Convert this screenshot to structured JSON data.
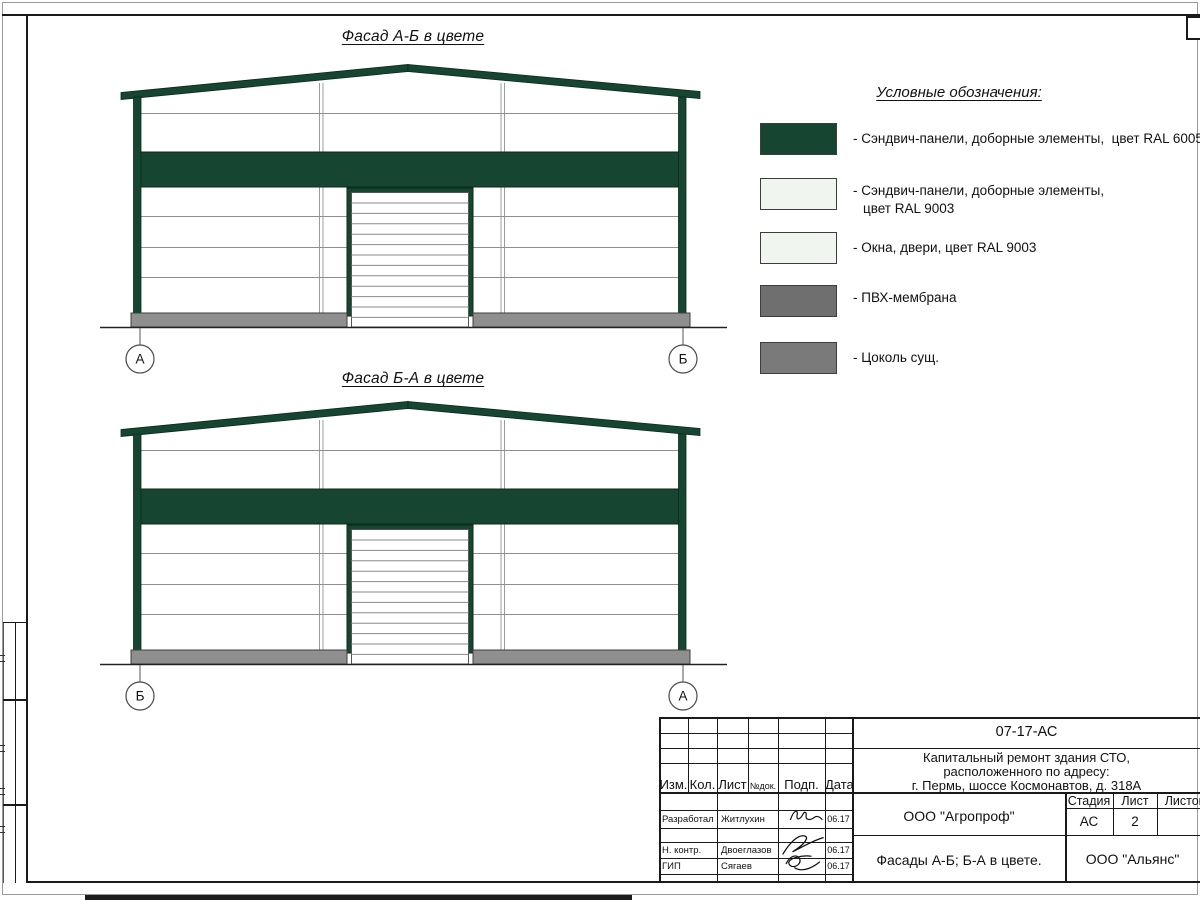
{
  "facades": {
    "top": {
      "title": "Фасад А-Б в цвете",
      "marker_left": "А",
      "marker_right": "Б"
    },
    "bottom": {
      "title": "Фасад Б-А в цвете",
      "marker_left": "Б",
      "marker_right": "А"
    }
  },
  "legend": {
    "title": "Условные обозначения:",
    "items": [
      {
        "color": "#164631",
        "label": "- Сэндвич-панели, доборные элементы,  цвет RAL 6005"
      },
      {
        "color": "#f0f5f0",
        "label": "- Сэндвич-панели, доборные элементы,",
        "label2": "цвет RAL 9003"
      },
      {
        "color": "#f0f5f0",
        "label": "- Окна, двери, цвет RAL 9003"
      },
      {
        "color": "#6f6f6f",
        "label": "- ПВХ-мембрана"
      },
      {
        "color": "#7a7a7a",
        "label": "- Цоколь сущ."
      }
    ]
  },
  "title_block": {
    "doc_number": "07-17-АС",
    "project_line1": "Капитальный ремонт здания СТО,",
    "project_line2": "расположенного по адресу:",
    "project_line3": "г. Пермь, шоссе Космонавтов, д. 318А",
    "col_izm": "Изм.",
    "col_kol": "Кол.",
    "col_list": "Лист",
    "col_ndok": "№док.",
    "col_podp": "Подп.",
    "col_data": "Дата",
    "rows": [
      {
        "role": "Разработал",
        "name": "Житлухин",
        "date": "06.17"
      },
      {
        "role": "Н. контр.",
        "name": "Двоеглазов",
        "date": "06.17"
      },
      {
        "role": "ГИП",
        "name": "Сягаев",
        "date": "06.17"
      }
    ],
    "org": "ООО \"Агропроф\"",
    "stage_label": "Стадия",
    "sheet_label": "Лист",
    "sheets_label": "Листов",
    "stage": "АС",
    "sheet_num": "2",
    "drawing_title": "Фасады А-Б; Б-А в цвете.",
    "contractor": "ООО \"Альянс\""
  },
  "colors": {
    "ral6005_green": "#164631",
    "ral9003_white": "#f0f5f0",
    "membrane_gray": "#6f6f6f",
    "plinth_gray": "#8f8f8f"
  }
}
